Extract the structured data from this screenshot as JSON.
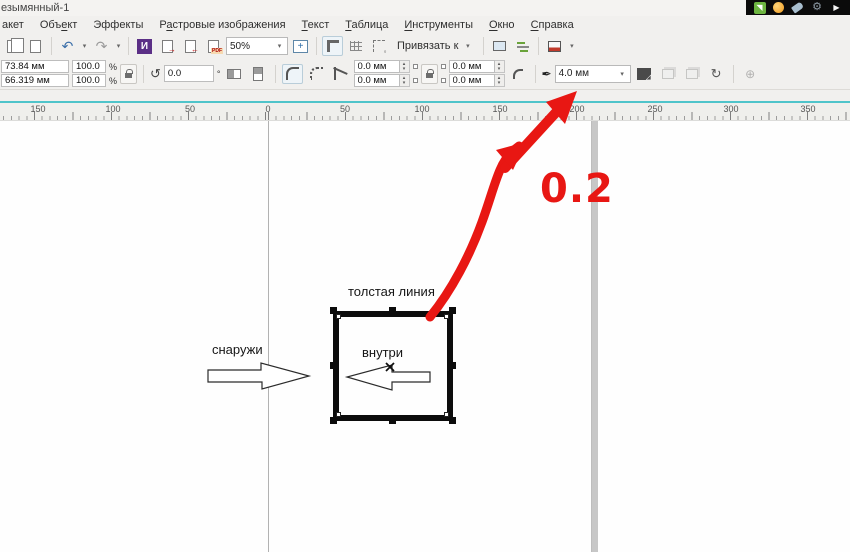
{
  "window": {
    "title": "езымянный-1"
  },
  "overlay_strip": {
    "icons": [
      "screen-capture-icon",
      "globe-icon",
      "tag-icon",
      "gear-icon",
      "play-icon"
    ],
    "gear_glyph": "⚙",
    "play_glyph": "▶",
    "capture_glyph": "◥"
  },
  "menubar": {
    "items": [
      {
        "html": "акет"
      },
      {
        "html": "Объ<u>е</u>кт"
      },
      {
        "html": "Эффекты"
      },
      {
        "html": "Р<u>а</u>стровые изображения"
      },
      {
        "html": "<u>Т</u>екст"
      },
      {
        "html": "<u>Т</u>аблица"
      },
      {
        "html": "<u>И</u>нструменты"
      },
      {
        "html": "<u>О</u>кно"
      },
      {
        "html": "<u>С</u>правка"
      }
    ]
  },
  "toolbar": {
    "zoom_level": "50%",
    "snap_label": "Привязать к",
    "pdf_label": "PDF"
  },
  "icons": {
    "undo": "↶",
    "redo": "↷",
    "chevron_down": "▾",
    "spinner_up": "▴",
    "spinner_down": "▾",
    "rotate_ccw": "↺",
    "plus": "+",
    "pen": "✒",
    "symmetry": "↻",
    "target_plus": "⊕",
    "purple_app": "И"
  },
  "propbar": {
    "x_value": "73.84 мм",
    "y_value": "66.319 мм",
    "scale_x": "100.0",
    "scale_y": "100.0",
    "percent": "%",
    "rotation": "0.0",
    "degree": "°",
    "corner_radius_tl": "0.0 мм",
    "corner_radius_bl": "0.0 мм",
    "corner_radius_tr": "0.0 мм",
    "corner_radius_br": "0.0 мм",
    "outline_width": "4.0 мм"
  },
  "ruler": {
    "labels": [
      "150",
      "100",
      "50",
      "0",
      "50",
      "100",
      "150",
      "200",
      "250",
      "300",
      "350"
    ]
  },
  "canvas": {
    "labels": {
      "thick_line": "толстая линия",
      "outside": "снаружи",
      "inside": "внутри"
    },
    "annotation": {
      "text": "0.2"
    }
  },
  "colors": {
    "annotation_red": "#e81713",
    "teal_divider": "#4fc4ca",
    "selection_handle": "#0c0c0c",
    "chrome_bg": "#f1f0ee"
  }
}
